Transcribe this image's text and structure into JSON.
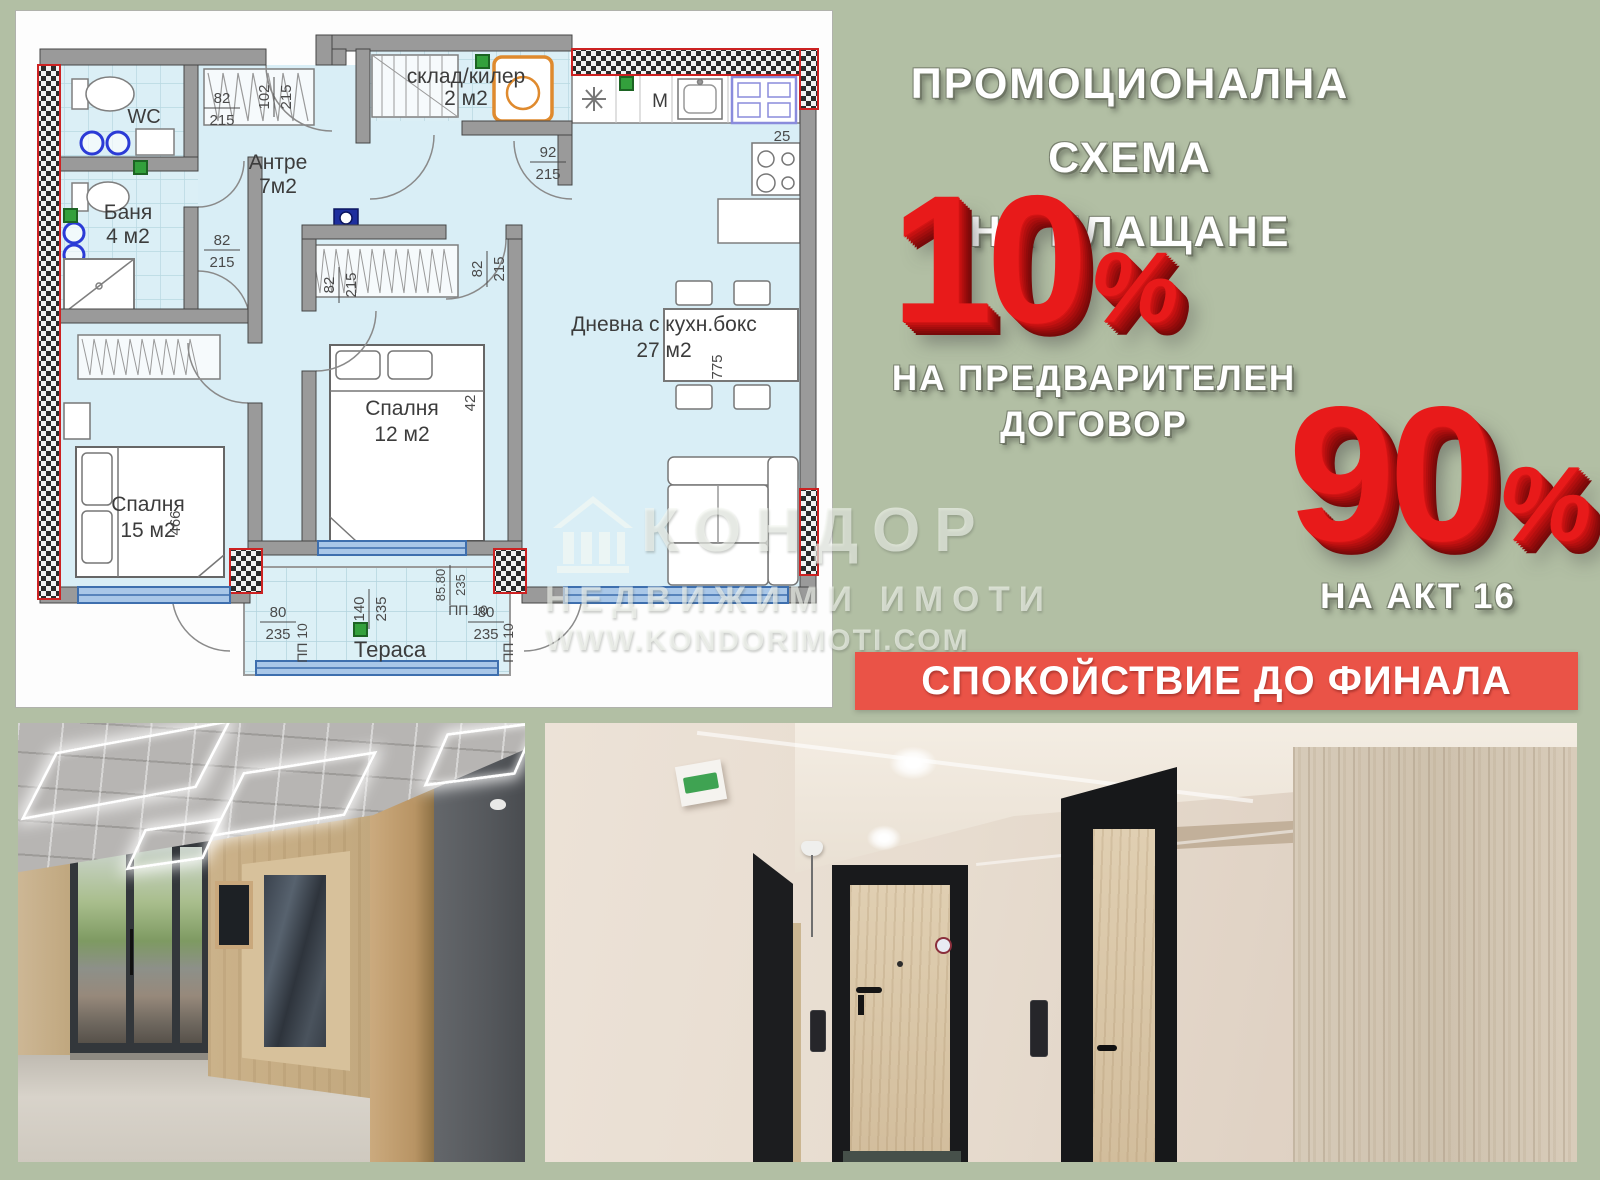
{
  "promo": {
    "title_line1": "ПРОМОЦИОНАЛНА СХЕМА",
    "title_line2": "НА ПЛАЩАНЕ",
    "discount_preliminary": {
      "value": "10",
      "percent_sign": "%",
      "label_line1": "НА ПРЕДВАРИТЕЛЕН",
      "label_line2": "ДОГОВОР"
    },
    "discount_act16": {
      "value": "90",
      "percent_sign": "%",
      "label": "НА АКТ 16"
    },
    "banner_text": "СПОКОЙСТВИЕ ДО ФИНАЛА",
    "colors": {
      "background_sage": "#b2bfa4",
      "banner_red": "#ea5347",
      "number_red": "#e81a1a",
      "text_white": "#ffffff",
      "plan_blue": "#d9eef6"
    }
  },
  "watermark": {
    "brand": "КОНДОР",
    "line2": "НЕДВИЖИМИ ИМОТИ",
    "line3": "WWW.KONDORIMOTI.COM"
  },
  "floor_plan": {
    "rooms": [
      {
        "name": "WC",
        "area": ""
      },
      {
        "name": "Баня",
        "area": "4 м2"
      },
      {
        "name": "Антре",
        "area": "7м2"
      },
      {
        "name": "склад/килер",
        "area": "2 м2"
      },
      {
        "name": "Спалня",
        "area": "12 м2"
      },
      {
        "name": "Спалня",
        "area": "15 м2"
      },
      {
        "name": "Дневна с кухн.бокс",
        "area": "27 м2"
      },
      {
        "name": "Тераса",
        "area": ""
      }
    ],
    "door_dims": [
      {
        "w": "82",
        "h": "215"
      },
      {
        "w": "102",
        "h": "215"
      },
      {
        "w": "82",
        "h": "215"
      },
      {
        "w": "82",
        "h": "215"
      },
      {
        "w": "82",
        "h": "215"
      },
      {
        "w": "92",
        "h": "215"
      }
    ],
    "terrace_dims": [
      {
        "w": "80",
        "h": "235"
      },
      {
        "w": "140",
        "h": "235"
      },
      {
        "w": "80",
        "h": "235"
      },
      {
        "w": "85.80",
        "h": "235"
      }
    ],
    "other_dims": {
      "cabinet": "25",
      "table": "775",
      "bed15": "466",
      "wall": "42",
      "pp1": "ПП 10",
      "pp2": "ПП 10",
      "pp3": "ПП 10"
    },
    "kitchen_marks": {
      "microwave": "M"
    }
  }
}
